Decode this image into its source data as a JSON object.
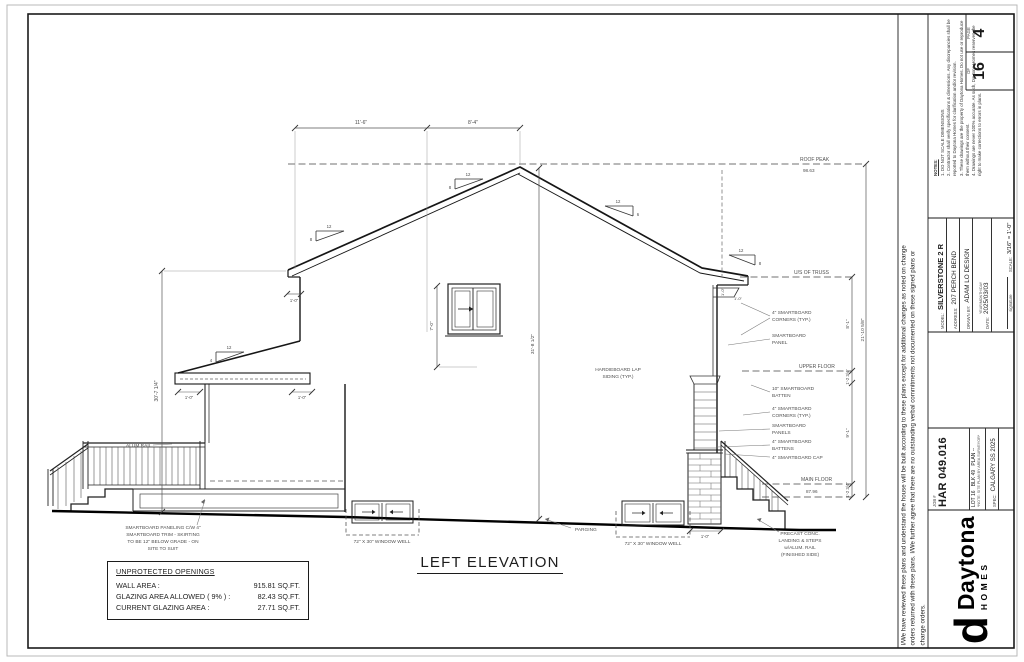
{
  "title_block": {
    "page_label": "PAGE",
    "page_number": "4",
    "of_label": "OF",
    "page_total": "16",
    "notes_heading": "NOTES:",
    "notes": [
      "1. DO NOT SCALE DIMENSIONS",
      "2. Contractor shall verify specifications & dimensions. Any discrepancies shall be reported to Daytona Homes for clarification and/or revision.",
      "3. These drawings are the property of Daytona Homes. Do not use or reproduce them without their consent.",
      "4. Drawings are never 100% accurate. As such, Daytona Homes reserves the right to make corrections to errors in plans."
    ],
    "signature_label": "signature",
    "model_label": "MODEL:",
    "model": "SILVERSTONE 2 R",
    "address_label": "ADDRESS:",
    "address": "207 PERCH BEND",
    "drawn_by_label": "DRAWN BY:",
    "drawn_by": "ADAM LO DESIGN",
    "date_label": "DATE:",
    "date_format": "YEAR/MONTH/DAY",
    "date": "2025/03/03",
    "scale_label": "SCALE:",
    "scale": "3/16\" = 1'-0\"",
    "disclaimer": "I/We have reviewed these plans and understand the house will be built according to these plans except for additional changes as noted on change orders returned with these plans. I/We further agree that there are no outstanding verbal commitments not documented on these signed plans or change orders.",
    "job_label": "JOB #",
    "job_number": "HAR 049.016",
    "lot_line": "LOT 16   BLK 49   PLAN --",
    "lot_note": "*NOTE: SITE PLAN BY AREA SURVEYOR*",
    "spec_label": "SPEC:",
    "spec": "CALGARY SS 2025",
    "logo_brand": "Daytona",
    "logo_sub": "HOMES"
  },
  "openings_table": {
    "title": "UNPROTECTED OPENINGS",
    "rows": [
      {
        "label": "WALL AREA :",
        "value": "915.81 SQ.FT."
      },
      {
        "label": "GLAZING AREA ALLOWED ( 9% ) :",
        "value": "82.43 SQ.FT."
      },
      {
        "label": "CURRENT GLAZING AREA :",
        "value": "27.71 SQ.FT."
      }
    ]
  },
  "drawing": {
    "title": "LEFT ELEVATION",
    "top_dim_left": "11'-6\"",
    "top_dim_right": "8'-4\"",
    "left_height_dim": "30'-7 1/4\"",
    "window_height_dim": "7'-0\"",
    "overall_mid_dim": "31'-8 1/2\"",
    "eave_overhang_dim": "1'-0\"",
    "porch_overhang_left_dim": "1'-0\"",
    "porch_overhang_right_dim": "1'-0\"",
    "right_eave_dim_a": "1'-0\"",
    "right_eave_dim_b": "1'-0\"",
    "foundation_dim": "1'-0\"",
    "dim_truss_to_upper": "8'-1\"",
    "dim_upper_joist": "1'-2 3/4\"",
    "dim_upper_to_main": "9'-1\"",
    "dim_main_joist": "1'-2 3/4\"",
    "dim_overall_height": "21'-10 5/8\"",
    "pitch_run": "12",
    "pitch_rise_8": "8",
    "pitch_rise_6": "6",
    "pitch_rise_4": "4",
    "levels": {
      "roof_peak_label": "ROOF PEAK",
      "roof_peak_value": "98.63",
      "us_truss_label": "U/S OF TRUSS",
      "upper_floor_label": "UPPER FLOOR",
      "main_floor_label": "MAIN FLOOR",
      "main_floor_value": "87.96"
    },
    "ann": {
      "alum_rail": "ALUM RAIL",
      "skirting_1": "SMARTBOARD PANELING C/W 4\"",
      "skirting_2": "SMARTBOARD TRIM - SKIRTING",
      "skirting_3": "TO BE 12\" BELOW GRADE - ON",
      "skirting_4": "SITE TO SUIT",
      "window_well_1": "72\" X 30\" WINDOW WELL",
      "window_well_2": "72\" X 30\" WINDOW WELL",
      "parging": "PARGING",
      "hardie_1": "HARDIEBOARD LAP",
      "hardie_2": "SIDING (TYP.)",
      "corners_1a": "4\" SMARTBOARD",
      "corners_1b": "CORNERS (TYP.)",
      "panel_a": "SMARTBOARD",
      "panel_b": "PANEL",
      "batten10_a": "10\" SMARTBOARD",
      "batten10_b": "BATTEN",
      "corners_2a": "4\" SMARTBOARD",
      "corners_2b": "CORNERS (TYP.)",
      "panels_a": "SMARTBOARD",
      "panels_b": "PANELS",
      "battens4_a": "4\" SMARTBOARD",
      "battens4_b": "BATTENS",
      "cap": "4\" SMARTBOARD CAP",
      "precast_1": "PRECAST CONC.",
      "precast_2": "LANDING & STEPS",
      "precast_3": "w/ALUM. RAIL",
      "precast_4": "(FINISHED SIDE)"
    }
  }
}
